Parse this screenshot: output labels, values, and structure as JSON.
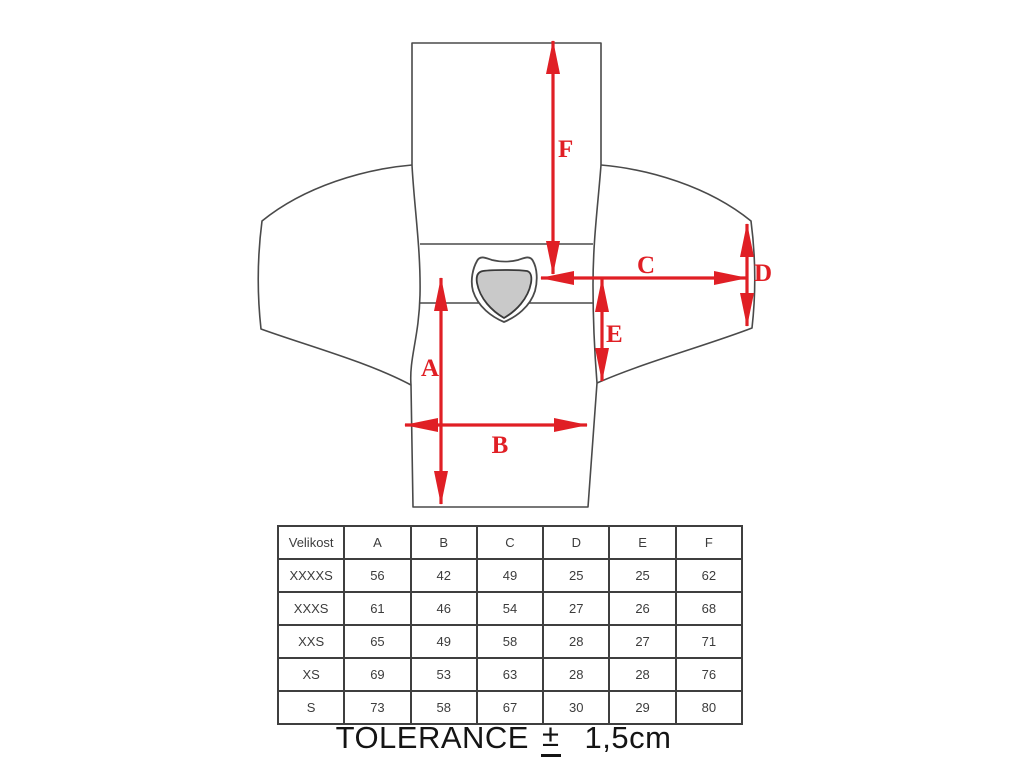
{
  "colors": {
    "arrow": "#e01f25",
    "outline": "#4a4a4a",
    "patch_fill": "#c9c9c9",
    "table_border": "#3f3f3f",
    "text": "#3c3c3c"
  },
  "diagram": {
    "description": "flat-laid jersey with measurement arrows",
    "labels": {
      "A": "A",
      "B": "B",
      "C": "C",
      "D": "D",
      "E": "E",
      "F": "F"
    }
  },
  "table": {
    "headers": [
      "Velikost",
      "A",
      "B",
      "C",
      "D",
      "E",
      "F"
    ],
    "rows": [
      [
        "XXXXS",
        "56",
        "42",
        "49",
        "25",
        "25",
        "62"
      ],
      [
        "XXXS",
        "61",
        "46",
        "54",
        "27",
        "26",
        "68"
      ],
      [
        "XXS",
        "65",
        "49",
        "58",
        "28",
        "27",
        "71"
      ],
      [
        "XS",
        "69",
        "53",
        "63",
        "28",
        "28",
        "76"
      ],
      [
        "S",
        "73",
        "58",
        "67",
        "30",
        "29",
        "80"
      ]
    ]
  },
  "tolerance": {
    "label": "TOLERANCE",
    "pm": "±",
    "value": "1,5cm"
  }
}
